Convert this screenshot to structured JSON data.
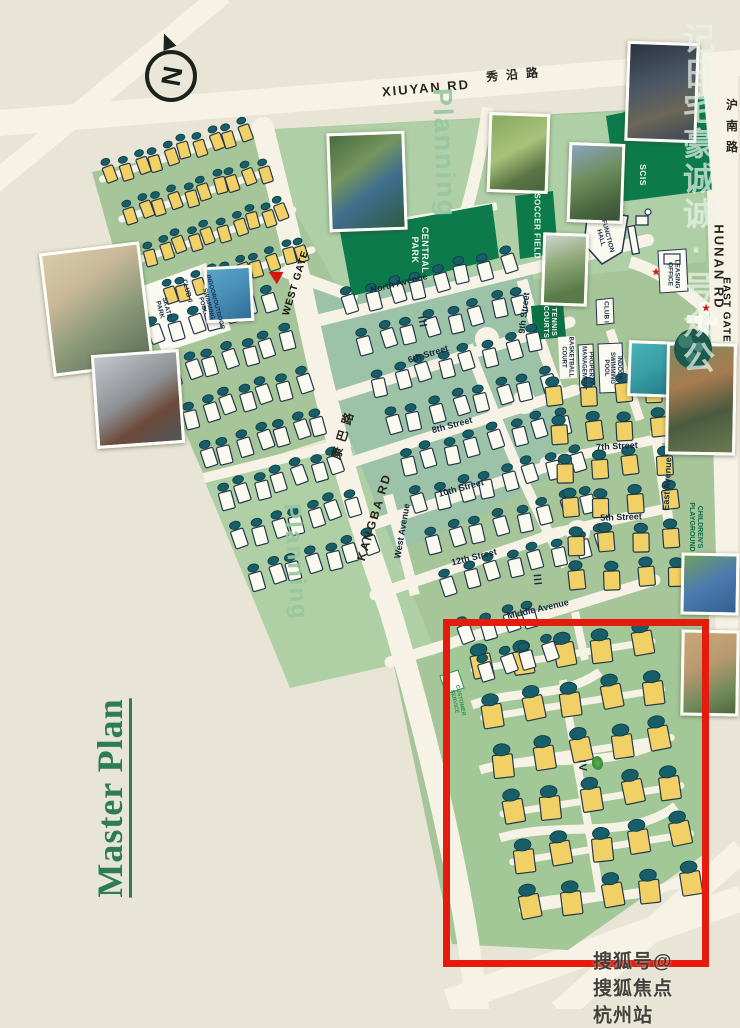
{
  "title": {
    "master_plan": "Master Plan"
  },
  "compass": {
    "letter": "N"
  },
  "icons": {
    "gate_star": "★"
  },
  "roads": {
    "xiuyan_en": "XIUYAN RD",
    "xiuyan_cn": "秀沿路",
    "hunan_en": "HUNAN RD",
    "hunan_cn": "沪南路",
    "kangba_en": "KANGBA RD",
    "kangba_cn": "康巴路"
  },
  "gates": {
    "west": "WEST GATE",
    "east": "EAST GATE"
  },
  "streets": {
    "north": "North Avenue",
    "ninth": "9th Street",
    "sixth": "6th Street",
    "eighth": "8th Street",
    "seventh": "7th Street",
    "tenth": "10th Street",
    "fifth": "5th Street",
    "twelfth": "12th Street",
    "middle": "Middle Avenue",
    "east": "East Avenue",
    "west": "West Avenue"
  },
  "areas": {
    "planning_top": "Planning",
    "planning_bottom": "Planning",
    "central_park": "CENTRAL\nPARK",
    "soccer_field": "SOCCER FIELD",
    "scis": "SCIS",
    "tennis": "TENNIS\nCOURTS",
    "childrens_playground": "CHILDREN'S\nPLAYGROUND"
  },
  "facilities": {
    "skate_park": "SKATE\nPARK",
    "club_ii": "CLUB II",
    "io_pool": "INDOOR/OUTDOOR\nSWIMMING\nPOOL",
    "club_i": "CLUB I",
    "basketball": "BASKETBALL\nCOURT",
    "property": "PROPERTY\nMANAGEMENT",
    "indoor_pool": "INDOOR\nSWIMMING\nPOOL",
    "function_hall": "FUNCTION\nHALL",
    "leasing": "LEASING\nOFFICE",
    "customer_service": "CUSTOMER\nSERVICE"
  },
  "phases": {
    "a": "III",
    "b": "III",
    "c": "IV"
  },
  "watermarks": {
    "side_phrase": "公众号·诚诚豪宅日记",
    "side_display": "记日宅豪诚诚·号众公",
    "bottom": "搜狐号@搜狐焦点杭州站"
  },
  "map": {
    "highlight_box": {
      "color": "#e51b0d"
    },
    "colors": {
      "background": "#e9e5d6",
      "road": "#f6f3e6",
      "green_main": "#a6c69a",
      "green_dark": "#0d7a4c",
      "house_yellow": "#f1d166",
      "house_white": "#fbfaf0",
      "tree": "#185e68",
      "outline": "#24374c"
    },
    "clusters": [
      {
        "name": "northwest-townhomes",
        "x": 112,
        "y": 176,
        "angle": -18,
        "cols": 10,
        "colGap": 15.5,
        "rows": 4,
        "rowGap": 44,
        "rowShift": 6,
        "w": 11,
        "h": 16,
        "color": "#f1d166",
        "rowRoad": true
      },
      {
        "name": "west-villas",
        "x": 158,
        "y": 336,
        "angle": -17,
        "cols": 7,
        "colGap": 19.5,
        "rows": 7,
        "rowGap": 44,
        "rowShift": 4,
        "w": 13,
        "h": 18,
        "color": "#fbfaf0",
        "rowRoad": false
      },
      {
        "name": "central-villas",
        "x": 352,
        "y": 306,
        "angle": -15,
        "cols": 8,
        "colGap": 23,
        "rows": 8,
        "rowGap": 42,
        "rowShift": 3,
        "w": 13,
        "h": 18,
        "color": "#fbfaf0",
        "rowRoad": false
      },
      {
        "name": "east-townhomes",
        "x": 556,
        "y": 398,
        "angle": -4,
        "cols": 4,
        "colGap": 33,
        "rows": 6,
        "rowGap": 37,
        "rowShift": 2,
        "w": 16,
        "h": 19,
        "color": "#f1d166",
        "rowRoad": false
      },
      {
        "name": "phase-iv-villas",
        "x": 484,
        "y": 668,
        "angle": -9,
        "cols": 5,
        "colGap": 40,
        "rows": 6,
        "rowGap": 49,
        "rowShift": 2,
        "w": 20,
        "h": 23,
        "color": "#f1d166",
        "rowRoad": true
      },
      {
        "name": "box-north-villas",
        "x": 468,
        "y": 636,
        "angle": -17,
        "cols": 4,
        "colGap": 22,
        "rows": 2,
        "rowGap": 40,
        "rowShift": 8,
        "w": 13,
        "h": 18,
        "color": "#fbfaf0",
        "rowRoad": false
      }
    ]
  }
}
